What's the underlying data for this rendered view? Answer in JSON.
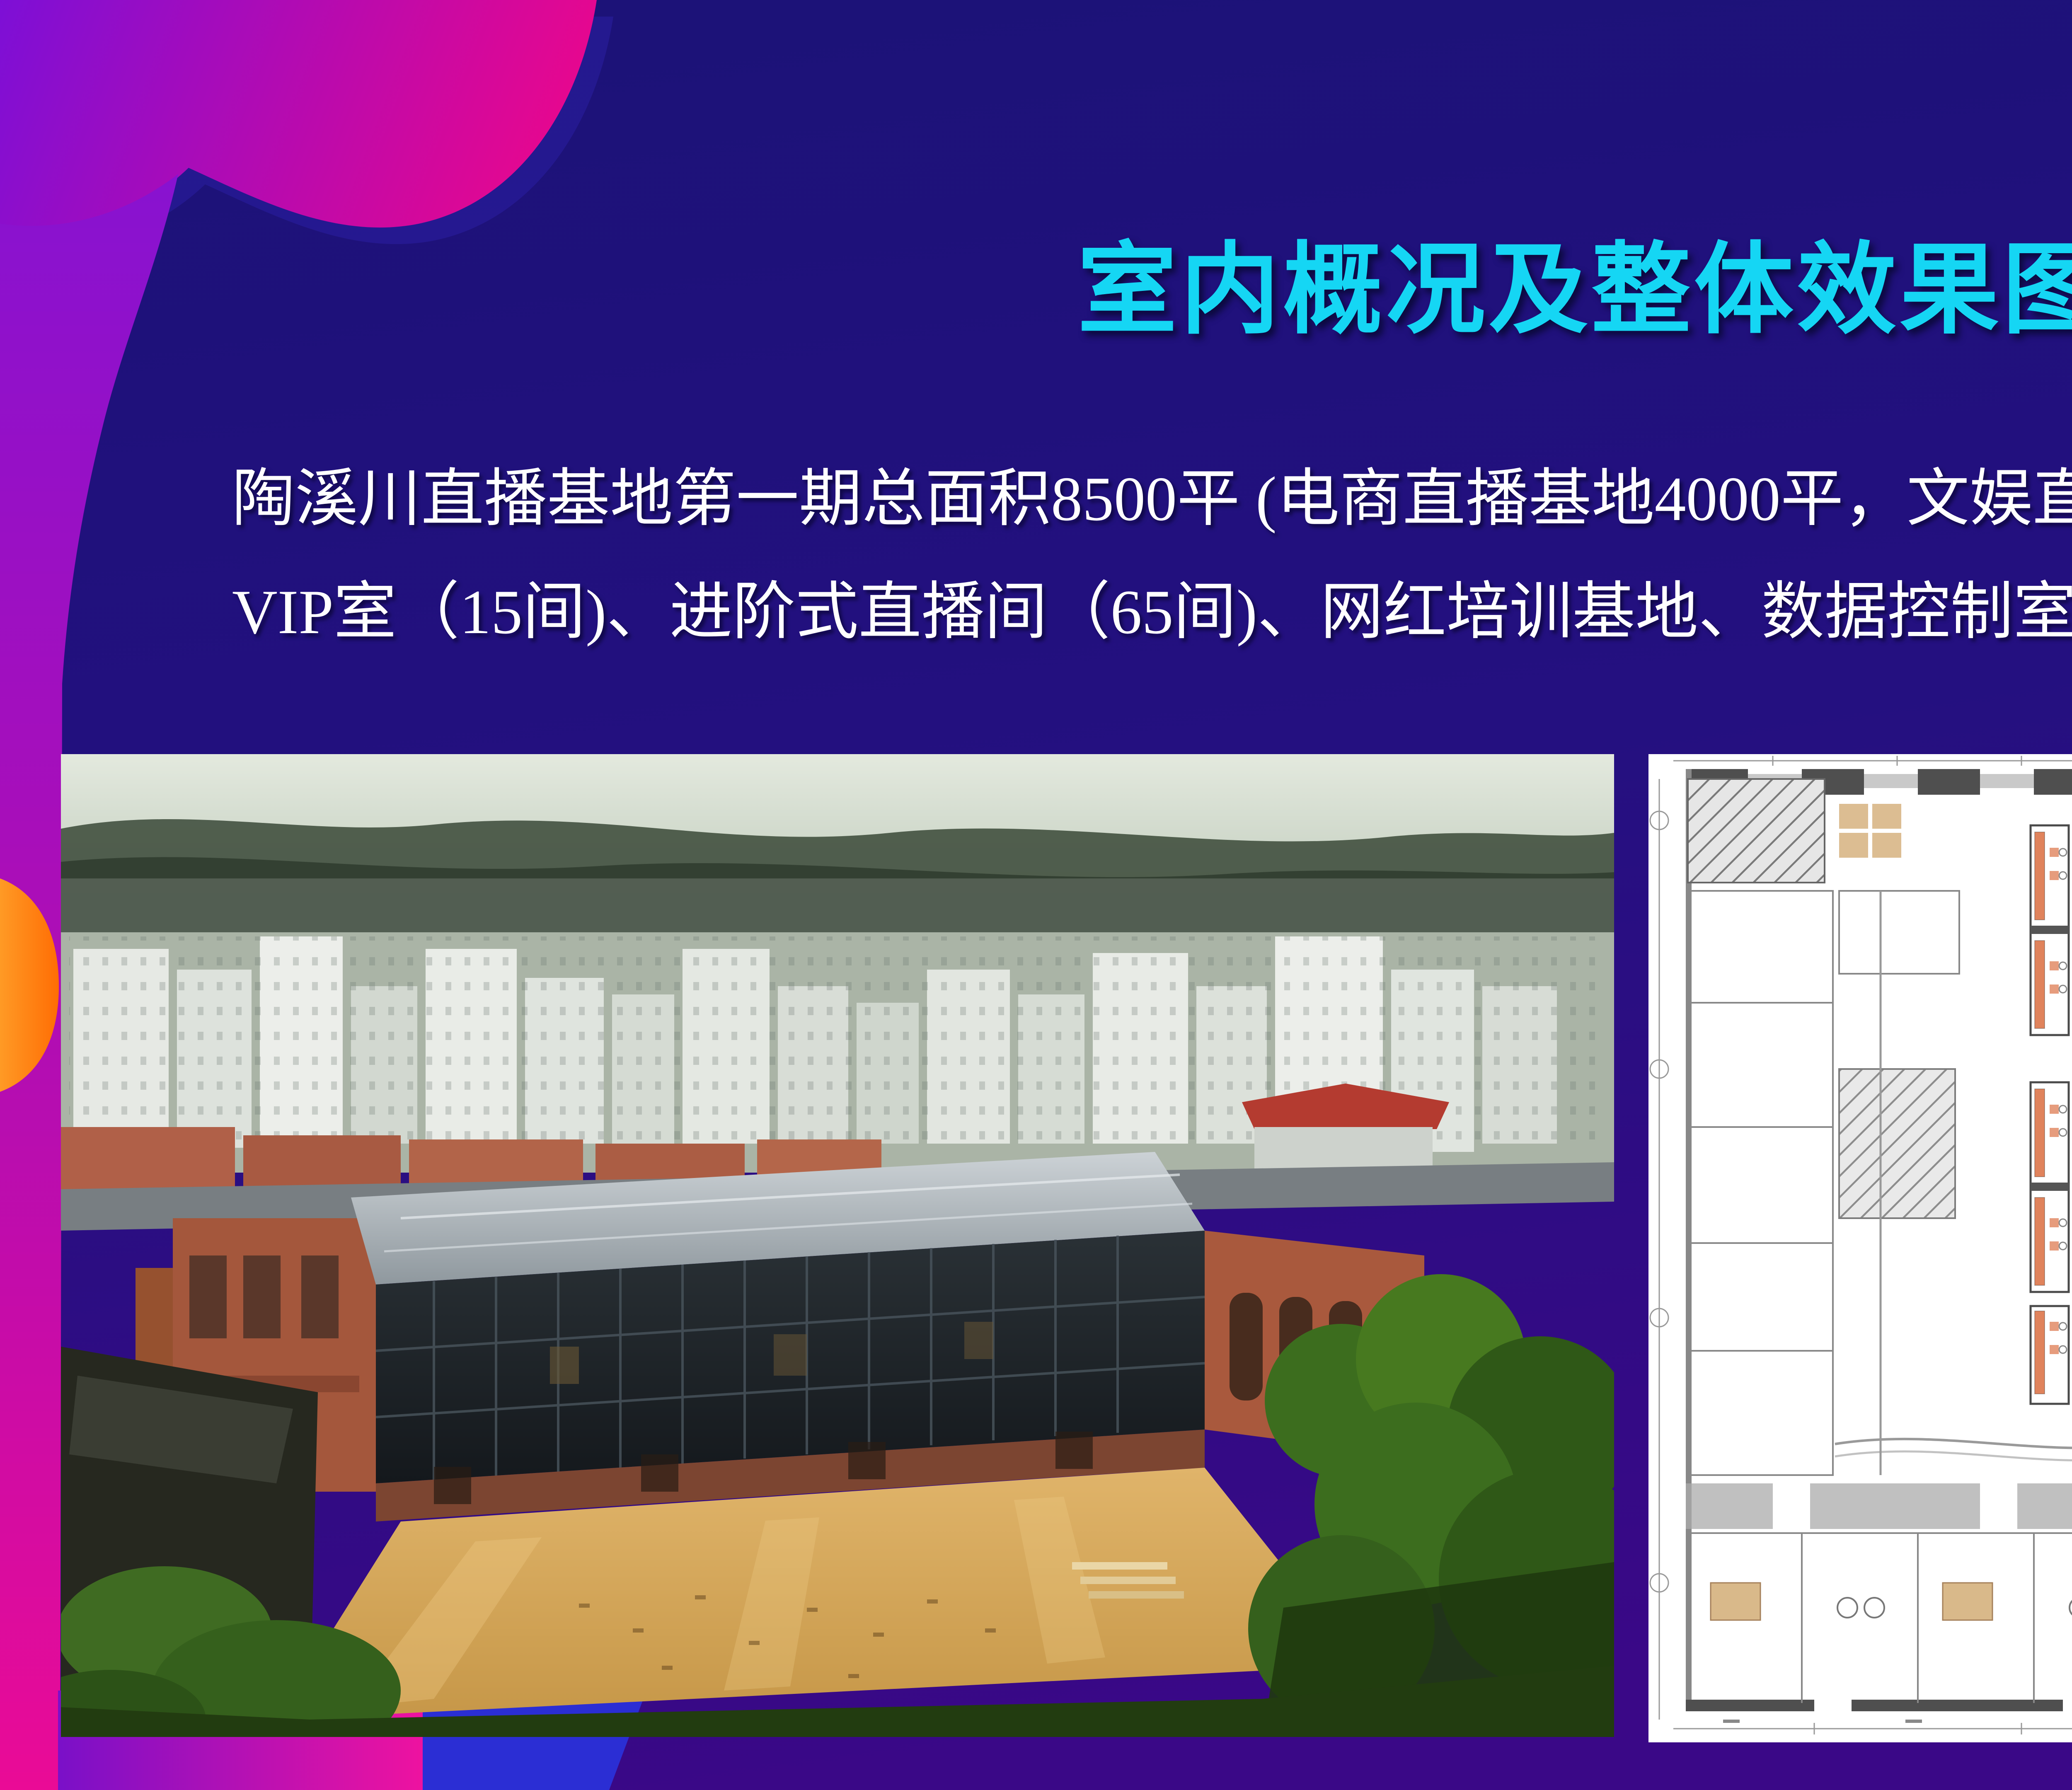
{
  "slide": {
    "title": "室内概况及整体效果图",
    "body": {
      "line1": "陶溪川直播基地第一期总面积8500平 (电商直播基地4000平，文娱直播基地4500平)。配套有平台机 构",
      "line2": "VIP室（15间)、进阶式直播间（65间)、网红培训基地、数据控制室、 录音棚、网红练习室、秀场等。"
    },
    "colors": {
      "title": "#15d6f4",
      "body_text": "#ffffff",
      "background_top": "#1b1277",
      "background_bottom": "#3a0887",
      "decor_magenta": "#e6078f",
      "decor_purple": "#8a0bd8",
      "decor_blue": "#2b2ed4",
      "decor_orange": "#ff8a1e",
      "decor_red": "#e81930",
      "decor_gold": "#f5a623"
    }
  },
  "floor_plan": {
    "legend": [
      {
        "label": "3.5m×2.8m，面积：9.8㎡",
        "color": "#e8825a"
      },
      {
        "label": "3.5m×3.1m，面积：11㎡",
        "color": "#87cbe6"
      },
      {
        "label": "2.875m×2.85m，面积：8㎡",
        "color": "#a3c6cf"
      },
      {
        "label": "3.2m×2.775m，面积：8.8㎡",
        "color": "#f3d783"
      }
    ]
  }
}
